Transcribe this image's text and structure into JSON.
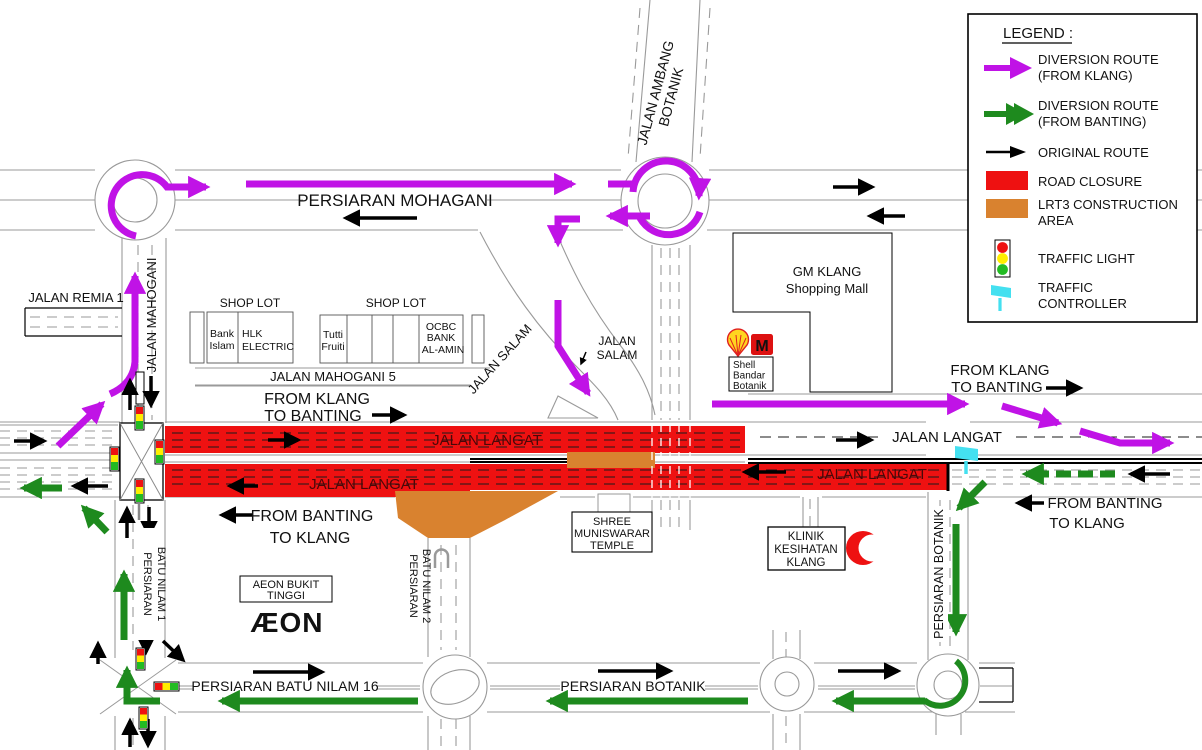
{
  "legend": {
    "title": "LEGEND :",
    "items": {
      "diversion_klang": {
        "line1": "DIVERSION ROUTE",
        "line2": "(FROM KLANG)"
      },
      "diversion_banting": {
        "line1": "DIVERSION ROUTE",
        "line2": "(FROM BANTING)"
      },
      "original_route": {
        "line1": "ORIGINAL ROUTE"
      },
      "road_closure": {
        "line1": "ROAD CLOSURE"
      },
      "lrt3": {
        "line1": "LRT3 CONSTRUCTION",
        "line2": "AREA"
      },
      "traffic_light": {
        "line1": "TRAFFIC LIGHT"
      },
      "traffic_controller": {
        "line1": "TRAFFIC",
        "line2": "CONTROLLER"
      }
    }
  },
  "roads": {
    "persiaran_mohagani": "PERSIARAN MOHAGANI",
    "jalan_ambang_botanik_line1": "JALAN AMBANG",
    "jalan_ambang_botanik_line2": "BOTANIK",
    "jalan_mahogani": "JALAN MAHOGANI",
    "jalan_remia_1": "JALAN REMIA 1",
    "jalan_mahogani_5": "JALAN MAHOGANI 5",
    "jalan_salam": "JALAN SALAM",
    "jalan_salam_line1": "JALAN",
    "jalan_salam_line2": "SALAM",
    "jalan_langat": "JALAN LANGAT",
    "persiaran_batu_nilam_1_line1": "PERSIARAN",
    "persiaran_batu_nilam_1_line2": "BATU NILAM 1",
    "persiaran_batu_nilam_2_line1": "PERSIARAN",
    "persiaran_batu_nilam_2_line2": "BATU NILAM 2",
    "persiaran_batu_nilam_16": "PERSIARAN BATU NILAM 16",
    "persiaran_botanik": "PERSIARAN BOTANIK"
  },
  "directions": {
    "from_klang_line1": "FROM KLANG",
    "from_klang_line2": "TO BANTING",
    "from_banting_line1": "FROM BANTING",
    "from_banting_line2": "TO KLANG"
  },
  "places": {
    "shop_lot": "SHOP LOT",
    "bank_islam_line1": "Bank",
    "bank_islam_line2": "Islam",
    "hlk_line1": "HLK",
    "hlk_line2": "ELECTRIC",
    "tutti_line1": "Tutti",
    "tutti_line2": "Fruiti",
    "ocbc_line1": "OCBC",
    "ocbc_line2": "BANK",
    "ocbc_line3": "AL-AMIN",
    "gm_klang_line1": "GM KLANG",
    "gm_klang_line2": "Shopping Mall",
    "shell_line1": "Shell",
    "shell_line2": "Bandar",
    "shell_line3": "Botanik",
    "mcdonalds_m": "M",
    "temple_line1": "SHREE",
    "temple_line2": "MUNISWARAR",
    "temple_line3": "TEMPLE",
    "klinik_line1": "KLINIK",
    "klinik_line2": "KESIHATAN",
    "klinik_line3": "KLANG",
    "aeon_box_line1": "AEON BUKIT",
    "aeon_box_line2": "TINGGI",
    "aeon_logo": "ÆON"
  },
  "colors": {
    "diversion_from_klang": "#c013e6",
    "diversion_from_banting": "#1e8a1e",
    "original_route": "#000000",
    "road_closure": "#ee1111",
    "lrt3_construction": "#d9822f",
    "traffic_light_red": "#ee1111",
    "traffic_light_yellow": "#ffee00",
    "traffic_light_green": "#22bb22",
    "traffic_controller": "#44e0f0",
    "aeon_brand": "#b0359c"
  }
}
